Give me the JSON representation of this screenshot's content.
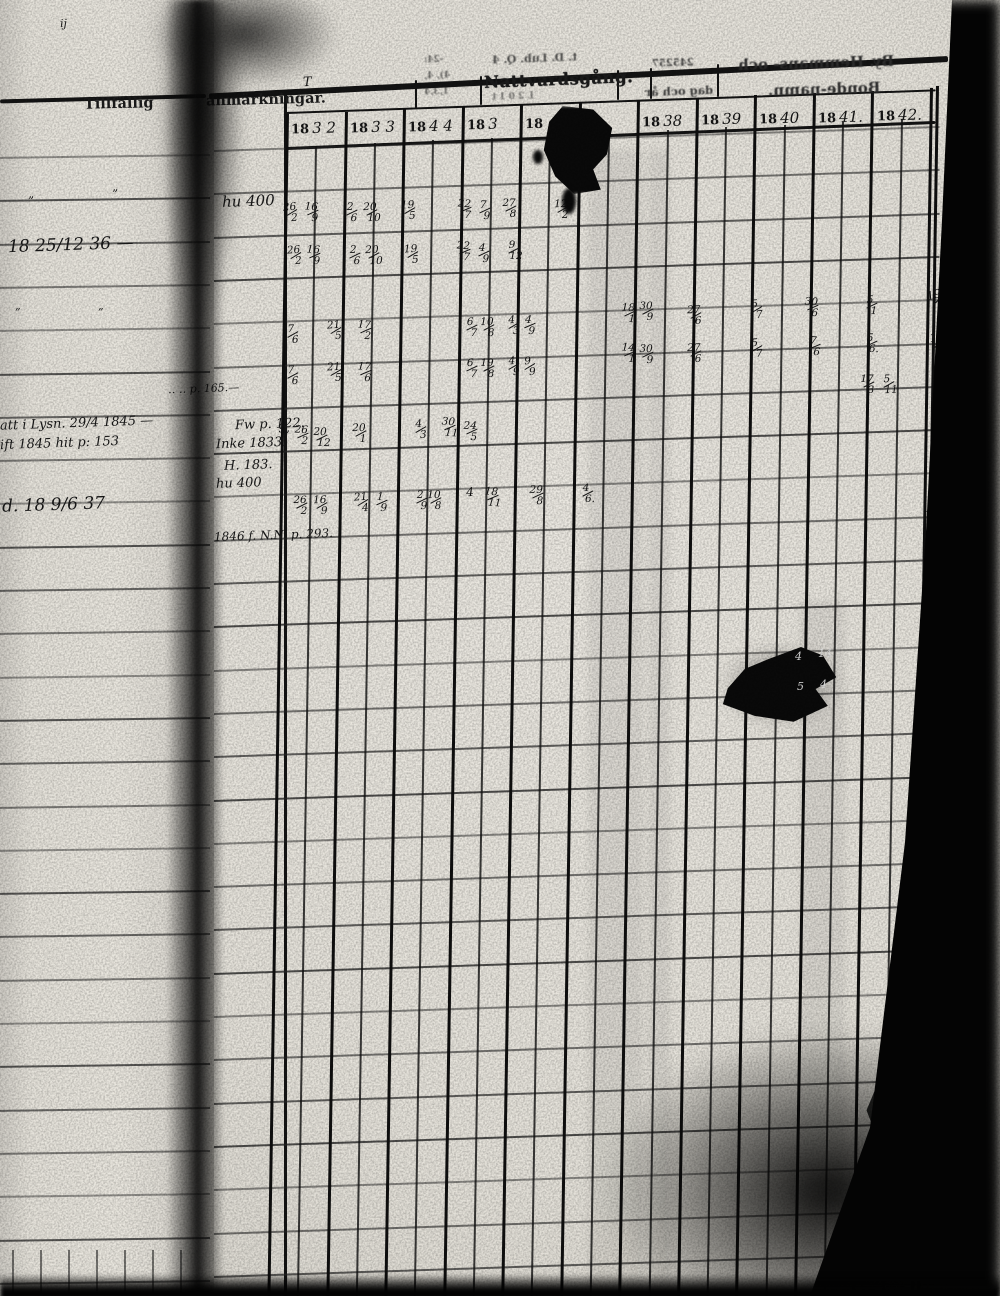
{
  "headers": {
    "remarks_1": "Tillfällig",
    "remarks_2": "anmärkningar.",
    "remarks_stray": "T",
    "sacrament": "Nattvardsgång.",
    "sacrament_bleed_over": "t. D. Lub. Q. 4",
    "sacrament_bleed_under": "L 2 0 1 t",
    "bleed_dates_small": "245257",
    "bleed_dag_och_ar": "dag och år",
    "bleed_by_line1": "By. Hemmans- och",
    "bleed_by_line2": "Bonde-namn.",
    "bleed_scribbles": [
      "-24:",
      "4), 4,",
      "1,3,4"
    ],
    "year_prefix": "18",
    "year_digits": [
      "3 2",
      "3 3",
      "4 4",
      "3",
      "",
      "",
      "38",
      "39",
      "40",
      "41.",
      "42."
    ]
  },
  "grid_entries": [
    {
      "x": 292,
      "y": 214,
      "t": "26/2"
    },
    {
      "x": 313,
      "y": 214,
      "t": "16/9"
    },
    {
      "x": 352,
      "y": 214,
      "t": "2/6"
    },
    {
      "x": 372,
      "y": 214,
      "t": "20/10"
    },
    {
      "x": 410,
      "y": 212,
      "t": "19/5"
    },
    {
      "x": 466,
      "y": 211,
      "t": "22/7"
    },
    {
      "x": 485,
      "y": 212,
      "t": "7/9"
    },
    {
      "x": 511,
      "y": 210,
      "t": "27/8"
    },
    {
      "x": 563,
      "y": 211,
      "t": "12/2"
    },
    {
      "x": 296,
      "y": 257,
      "t": "26/2"
    },
    {
      "x": 315,
      "y": 257,
      "t": "16/9"
    },
    {
      "x": 355,
      "y": 257,
      "t": "2/6"
    },
    {
      "x": 374,
      "y": 257,
      "t": "20/10"
    },
    {
      "x": 413,
      "y": 256,
      "t": "19/5"
    },
    {
      "x": 465,
      "y": 253,
      "t": "22/7"
    },
    {
      "x": 484,
      "y": 255,
      "t": "4/9"
    },
    {
      "x": 514,
      "y": 252,
      "t": "9/12"
    },
    {
      "x": 293,
      "y": 336,
      "t": "7/6"
    },
    {
      "x": 336,
      "y": 332,
      "t": "21/5"
    },
    {
      "x": 366,
      "y": 332,
      "t": "17/2"
    },
    {
      "x": 472,
      "y": 329,
      "t": "6/7"
    },
    {
      "x": 489,
      "y": 329,
      "t": "10/8"
    },
    {
      "x": 514,
      "y": 327,
      "t": "4/3"
    },
    {
      "x": 530,
      "y": 327,
      "t": "4/9"
    },
    {
      "x": 630,
      "y": 315,
      "t": "18/1"
    },
    {
      "x": 648,
      "y": 313,
      "t": "30/9"
    },
    {
      "x": 696,
      "y": 317,
      "t": "27/6"
    },
    {
      "x": 757,
      "y": 311,
      "t": "5/7"
    },
    {
      "x": 813,
      "y": 309,
      "t": "30/6"
    },
    {
      "x": 872,
      "y": 307,
      "t": "5/1"
    },
    {
      "x": 293,
      "y": 377,
      "t": "7/6"
    },
    {
      "x": 336,
      "y": 374,
      "t": "21/5"
    },
    {
      "x": 366,
      "y": 374,
      "t": "17/6"
    },
    {
      "x": 472,
      "y": 370,
      "t": "6/7"
    },
    {
      "x": 489,
      "y": 370,
      "t": "19/8"
    },
    {
      "x": 514,
      "y": 368,
      "t": "4/9"
    },
    {
      "x": 530,
      "y": 368,
      "t": "9/9"
    },
    {
      "x": 630,
      "y": 355,
      "t": "14/1"
    },
    {
      "x": 648,
      "y": 356,
      "t": "30/9"
    },
    {
      "x": 696,
      "y": 355,
      "t": "27/6"
    },
    {
      "x": 757,
      "y": 350,
      "t": "5/7"
    },
    {
      "x": 815,
      "y": 348,
      "t": "7/6"
    },
    {
      "x": 872,
      "y": 345,
      "t": "5/6."
    },
    {
      "x": 869,
      "y": 386,
      "t": "17/3"
    },
    {
      "x": 889,
      "y": 386,
      "t": "5/11"
    },
    {
      "x": 284,
      "y": 435,
      "t": "9,"
    },
    {
      "x": 303,
      "y": 437,
      "t": "26/2"
    },
    {
      "x": 322,
      "y": 439,
      "t": "20/12"
    },
    {
      "x": 361,
      "y": 435,
      "t": "20/1"
    },
    {
      "x": 421,
      "y": 431,
      "t": "4/3"
    },
    {
      "x": 450,
      "y": 429,
      "t": "30/11"
    },
    {
      "x": 472,
      "y": 433,
      "t": "24/5"
    },
    {
      "x": 302,
      "y": 507,
      "t": "26/2"
    },
    {
      "x": 322,
      "y": 507,
      "t": "16/9"
    },
    {
      "x": 363,
      "y": 504,
      "t": "21/4"
    },
    {
      "x": 382,
      "y": 504,
      "t": "1/9"
    },
    {
      "x": 422,
      "y": 502,
      "t": "2/9"
    },
    {
      "x": 436,
      "y": 502,
      "t": "10/8"
    },
    {
      "x": 470,
      "y": 499,
      "t": "4"
    },
    {
      "x": 493,
      "y": 499,
      "t": "18/11"
    },
    {
      "x": 538,
      "y": 497,
      "t": "29/8"
    },
    {
      "x": 588,
      "y": 495,
      "t": "4/6."
    }
  ],
  "margin_entries": [
    {
      "x": 938,
      "y": 302,
      "t": "19/2"
    },
    {
      "x": 940,
      "y": 345,
      "t": "12/9"
    },
    {
      "x": 942,
      "y": 384,
      "t": "14/11"
    },
    {
      "x": 936,
      "y": 521,
      "t": "19/4"
    }
  ],
  "remark_notes": [
    {
      "x": 222,
      "y": 207,
      "t": "hu 400",
      "s": 15
    },
    {
      "x": 303,
      "y": 88,
      "t": "T",
      "s": 13
    },
    {
      "x": 168,
      "y": 393,
      "t": "‥ ‥ p. 165.—",
      "s": 11
    },
    {
      "x": 235,
      "y": 430,
      "t": "Fw p. 122.",
      "s": 13
    },
    {
      "x": 216,
      "y": 449,
      "t": "Inke 1833.",
      "s": 13
    },
    {
      "x": 224,
      "y": 471,
      "t": "H. 183.",
      "s": 13
    },
    {
      "x": 216,
      "y": 489,
      "t": "hu 400",
      "s": 13
    },
    {
      "x": 214,
      "y": 540,
      "t": "1846 f. N.N. p. 293.",
      "s": 12
    }
  ],
  "left_page_notes": [
    {
      "x": 60,
      "y": 28,
      "t": "ij",
      "s": 11
    },
    {
      "x": 28,
      "y": 206,
      "t": "”",
      "s": 12
    },
    {
      "x": 112,
      "y": 199,
      "t": "”",
      "s": 12
    },
    {
      "x": 8,
      "y": 252,
      "t": "18 25/12 36 —",
      "s": 17
    },
    {
      "x": 15,
      "y": 317,
      "t": "”",
      "s": 11
    },
    {
      "x": 98,
      "y": 317,
      "t": "”",
      "s": 11
    },
    {
      "x": 0,
      "y": 429,
      "t": "att i Lysn. 29/4 1845 —",
      "s": 13
    },
    {
      "x": 0,
      "y": 449,
      "t": "ift 1845 hit p: 153",
      "s": 13
    },
    {
      "x": 2,
      "y": 512,
      "t": "d. 18 9/6 37",
      "s": 17
    }
  ],
  "hole_digits": [
    {
      "x": 795,
      "y": 658,
      "t": "4"
    },
    {
      "x": 818,
      "y": 655,
      "t": "14"
    },
    {
      "x": 797,
      "y": 688,
      "t": "5"
    },
    {
      "x": 820,
      "y": 686,
      "t": "4"
    }
  ],
  "colors": {
    "paper": "#e8e5de",
    "paper_left": "#e3e0d8",
    "ink": "#141414",
    "line": "#262626",
    "shadow": "#070707"
  }
}
